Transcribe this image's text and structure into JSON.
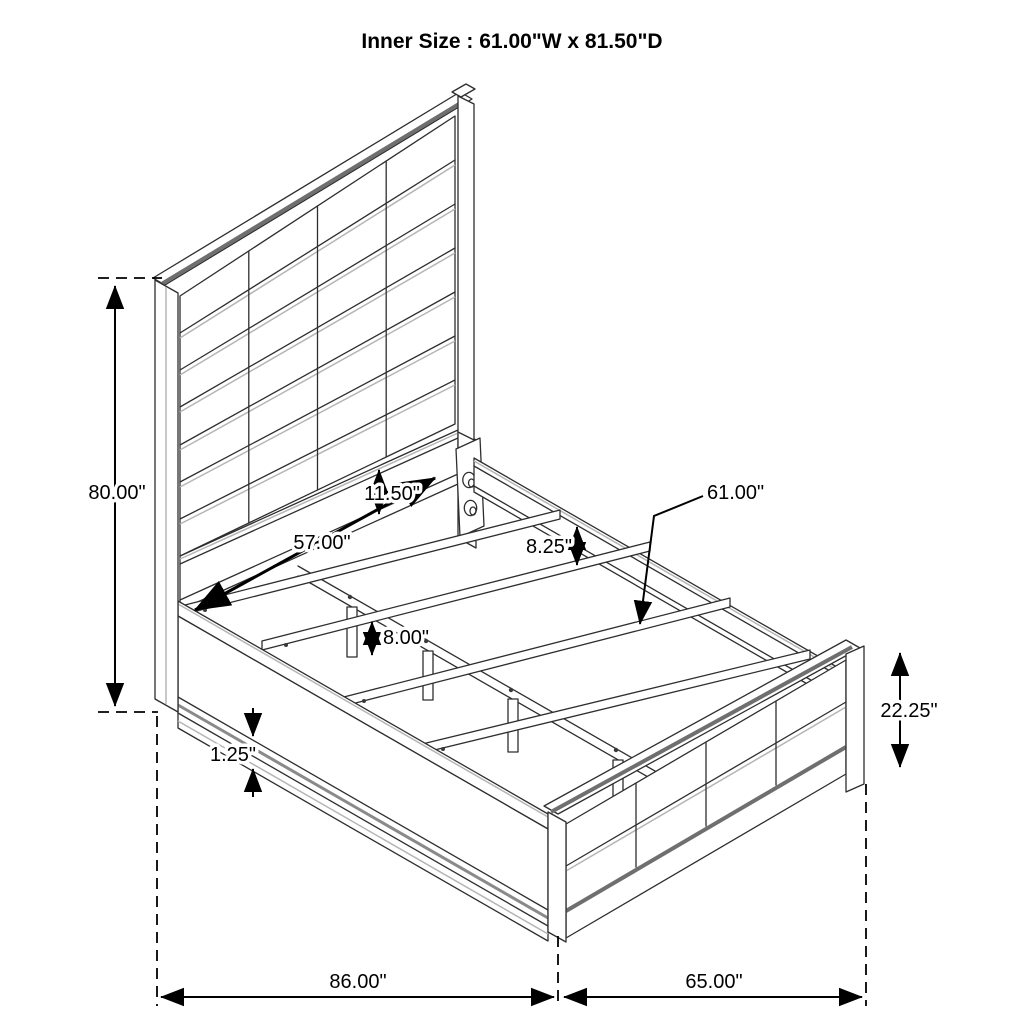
{
  "title": "Inner Size : 61.00\"W x 81.50\"D",
  "diagram": {
    "description": "Isometric line drawing of an upholstered channel-panel bed frame with dimension callouts",
    "line_color": "#2e2e2e",
    "dimension_color": "#000000",
    "background": "#ffffff",
    "labels": {
      "headboard_height": "80.00\"",
      "slat_span": "57.00\"",
      "head_rail_height": "11.50\"",
      "side_rail_height": "8.25\"",
      "inner_width": "61.00\"",
      "support_leg_height": "8.00\"",
      "rail_lip_thickness": "1.25\"",
      "footboard_height": "22.25\"",
      "overall_depth": "86.00\"",
      "footboard_width": "65.00\""
    }
  }
}
